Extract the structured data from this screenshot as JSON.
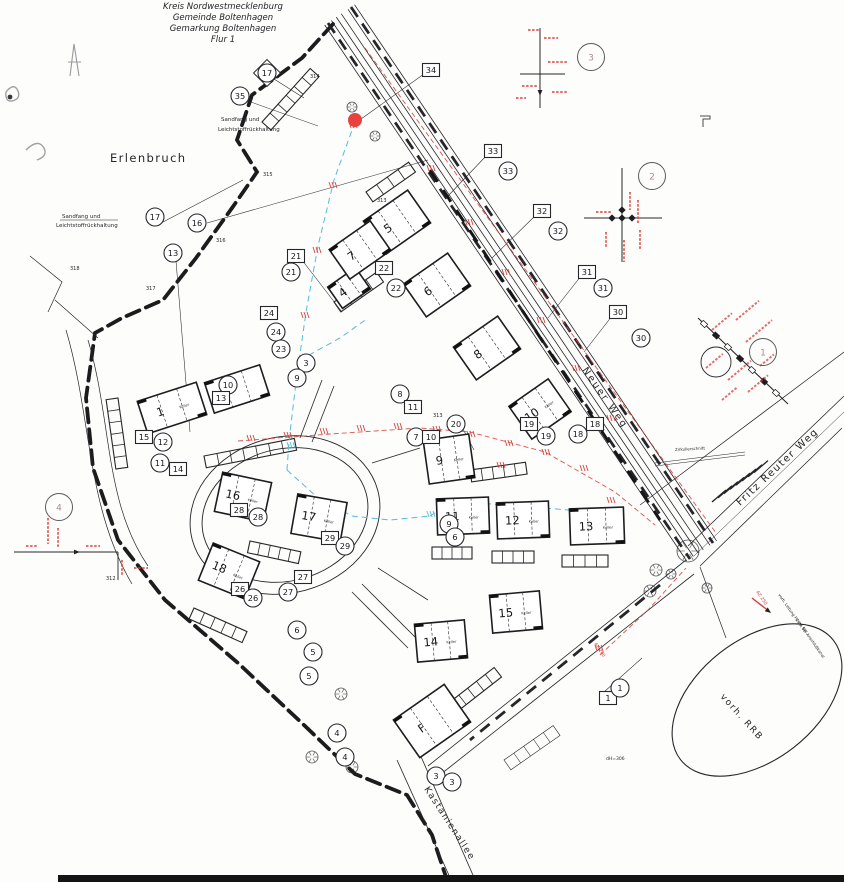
{
  "title": {
    "lines": [
      "Kreis Nordwestmecklenburg",
      "Gemeinde Boltenhagen",
      "Gemarkung Boltenhagen",
      "Flur 1"
    ]
  },
  "colors": {
    "ink": "#26262a",
    "red": "#d9403d",
    "cyan": "#53bcd9",
    "pencil": "#8f8f93",
    "faint": "#5a5a5a"
  },
  "map_texts": [
    {
      "name": "label-erlenbruch",
      "text": "Erlenbruch",
      "x": 110,
      "y": 162,
      "size": 11.5,
      "rot": 0,
      "ls": 1.4,
      "color": "ink"
    },
    {
      "name": "street-neuer-weg",
      "text": "Neuer Weg",
      "x": 582,
      "y": 370,
      "size": 9.5,
      "rot": 55,
      "ls": 2.2,
      "color": "ink"
    },
    {
      "name": "street-fritz-reuter-weg",
      "text": "Fritz Reuter Weg",
      "x": 740,
      "y": 506,
      "size": 10,
      "rot": -43,
      "ls": 1.6,
      "color": "ink"
    },
    {
      "name": "street-kastanienallee",
      "text": "Kastanienallee",
      "x": 424,
      "y": 789,
      "size": 9,
      "rot": 57,
      "ls": 1.4,
      "color": "ink"
    },
    {
      "name": "label-vorh-rrb",
      "text": "vorh. RRB",
      "x": 720,
      "y": 697,
      "size": 9,
      "rot": 48,
      "ls": 1.6,
      "color": "ink"
    },
    {
      "name": "note-sandfang-top-1",
      "text": "Sandfang und",
      "x": 221,
      "y": 121,
      "size": 5.5,
      "rot": 0,
      "ls": 0,
      "color": "ink"
    },
    {
      "name": "note-sandfang-top-2",
      "text": "Leichtstoffrückhaltung",
      "x": 218,
      "y": 131,
      "size": 5.5,
      "rot": 0,
      "ls": 0,
      "color": "ink"
    },
    {
      "name": "note-sandfang-left-1",
      "text": "Sandfang und",
      "x": 62,
      "y": 218,
      "size": 5.5,
      "rot": 0,
      "ls": 0,
      "color": "ink"
    },
    {
      "name": "note-sandfang-left-2",
      "text": "Leichtstoffrückhaltung",
      "x": 56,
      "y": 227,
      "size": 5.5,
      "rot": 0,
      "ls": 0,
      "color": "ink"
    },
    {
      "name": "note-zirkulierschnitt",
      "text": "Zirkulierschnitt",
      "x": 675,
      "y": 451,
      "size": 4,
      "rot": -3,
      "ls": 0,
      "color": "ink"
    },
    {
      "name": "note-dh306",
      "text": "dH=306",
      "x": 606,
      "y": 760,
      "size": 4.5,
      "rot": 0,
      "ls": 0,
      "color": "ink"
    },
    {
      "name": "note-az-250",
      "text": "AZ 250",
      "x": 756,
      "y": 592,
      "size": 4.5,
      "rot": 55,
      "ls": 0,
      "color": "red"
    },
    {
      "name": "note-az-200",
      "text": "AZ 200",
      "x": 594,
      "y": 644,
      "size": 4.5,
      "rot": 55,
      "ls": 0,
      "color": "red"
    },
    {
      "name": "note-leitung-pe",
      "text": "vorh. Leitung PE DA 90",
      "x": 778,
      "y": 595,
      "size": 4,
      "rot": 55,
      "ls": 0,
      "color": "ink"
    },
    {
      "name": "note-sw-anschluss",
      "text": "zum SW-Anschlußkanal",
      "x": 796,
      "y": 620,
      "size": 4,
      "rot": 55,
      "ls": 0,
      "color": "ink"
    },
    {
      "name": "parcel-312",
      "text": "312",
      "x": 106,
      "y": 580,
      "size": 5,
      "rot": 0,
      "ls": 0,
      "color": "ink"
    },
    {
      "name": "parcel-313",
      "text": "313",
      "x": 377,
      "y": 202,
      "size": 5,
      "rot": 0,
      "ls": 0,
      "color": "ink"
    },
    {
      "name": "parcel-313b",
      "text": "313",
      "x": 433,
      "y": 417,
      "size": 5,
      "rot": 0,
      "ls": 0,
      "color": "ink"
    },
    {
      "name": "parcel-314",
      "text": "314",
      "x": 310,
      "y": 78,
      "size": 5,
      "rot": 0,
      "ls": 0,
      "color": "ink"
    },
    {
      "name": "parcel-315",
      "text": "315",
      "x": 263,
      "y": 176,
      "size": 5,
      "rot": 0,
      "ls": 0,
      "color": "ink"
    },
    {
      "name": "parcel-316",
      "text": "316",
      "x": 216,
      "y": 242,
      "size": 5,
      "rot": 0,
      "ls": 0,
      "color": "ink"
    },
    {
      "name": "parcel-317",
      "text": "317",
      "x": 146,
      "y": 290,
      "size": 5,
      "rot": 0,
      "ls": 0,
      "color": "ink"
    },
    {
      "name": "parcel-318",
      "text": "318",
      "x": 70,
      "y": 270,
      "size": 5,
      "rot": 0,
      "ls": 0,
      "color": "ink"
    }
  ],
  "buildings": [
    {
      "n": "1",
      "x": 172,
      "y": 408,
      "w": 62,
      "h": 34,
      "rot": -18,
      "keller": true
    },
    {
      "n": "2",
      "x": 237,
      "y": 389,
      "w": 58,
      "h": 32,
      "rot": -18,
      "keller": false
    },
    {
      "n": "4",
      "x": 349,
      "y": 288,
      "w": 34,
      "h": 26,
      "rot": -35,
      "keller": false
    },
    {
      "n": "5",
      "x": 397,
      "y": 222,
      "w": 54,
      "h": 40,
      "rot": -35,
      "keller": false
    },
    {
      "n": "6",
      "x": 437,
      "y": 285,
      "w": 54,
      "h": 40,
      "rot": -35,
      "keller": false
    },
    {
      "n": "7",
      "x": 360,
      "y": 250,
      "w": 50,
      "h": 36,
      "rot": -35,
      "keller": false
    },
    {
      "n": "8",
      "x": 487,
      "y": 348,
      "w": 54,
      "h": 40,
      "rot": -35,
      "keller": false
    },
    {
      "n": "9",
      "x": 449,
      "y": 459,
      "w": 46,
      "h": 44,
      "rot": -8,
      "keller": true
    },
    {
      "n": "10",
      "x": 540,
      "y": 409,
      "w": 48,
      "h": 40,
      "rot": -35,
      "keller": true
    },
    {
      "n": "11",
      "x": 463,
      "y": 516,
      "w": 52,
      "h": 36,
      "rot": -2,
      "keller": true
    },
    {
      "n": "12",
      "x": 523,
      "y": 520,
      "w": 52,
      "h": 36,
      "rot": -2,
      "keller": true
    },
    {
      "n": "13",
      "x": 597,
      "y": 526,
      "w": 54,
      "h": 36,
      "rot": -2,
      "keller": true
    },
    {
      "n": "14",
      "x": 441,
      "y": 641,
      "w": 50,
      "h": 38,
      "rot": -5,
      "keller": true
    },
    {
      "n": "15",
      "x": 516,
      "y": 612,
      "w": 50,
      "h": 38,
      "rot": -5,
      "keller": true
    },
    {
      "n": "16",
      "x": 243,
      "y": 497,
      "w": 50,
      "h": 40,
      "rot": 12,
      "keller": true
    },
    {
      "n": "17",
      "x": 319,
      "y": 518,
      "w": 50,
      "h": 40,
      "rot": 10,
      "keller": true
    },
    {
      "n": "18",
      "x": 229,
      "y": 571,
      "w": 50,
      "h": 40,
      "rot": 22,
      "keller": true
    },
    {
      "n": "F",
      "x": 432,
      "y": 721,
      "w": 62,
      "h": 46,
      "rot": -35,
      "keller": false
    }
  ],
  "keller_label": "Keller",
  "markers": [
    {
      "n": "17",
      "shape": "diamond",
      "x": 267,
      "y": 73
    },
    {
      "n": "35",
      "shape": "circle",
      "x": 240,
      "y": 96
    },
    {
      "n": "34",
      "shape": "box",
      "x": 431,
      "y": 70
    },
    {
      "n": "3",
      "shape": "detail",
      "x": 591,
      "y": 57
    },
    {
      "n": "33",
      "shape": "box",
      "x": 493,
      "y": 151
    },
    {
      "n": "33",
      "shape": "circle",
      "x": 508,
      "y": 171
    },
    {
      "n": "2",
      "shape": "detail",
      "x": 652,
      "y": 176
    },
    {
      "n": "32",
      "shape": "box",
      "x": 542,
      "y": 211
    },
    {
      "n": "32",
      "shape": "circle",
      "x": 558,
      "y": 231
    },
    {
      "n": "17",
      "shape": "circle",
      "x": 155,
      "y": 217
    },
    {
      "n": "16",
      "shape": "circle",
      "x": 197,
      "y": 223
    },
    {
      "n": "13",
      "shape": "circle",
      "x": 173,
      "y": 253
    },
    {
      "n": "21",
      "shape": "box",
      "x": 296,
      "y": 256
    },
    {
      "n": "21",
      "shape": "circle",
      "x": 291,
      "y": 272
    },
    {
      "n": "22",
      "shape": "box",
      "x": 384,
      "y": 268
    },
    {
      "n": "22",
      "shape": "circle",
      "x": 396,
      "y": 288
    },
    {
      "n": "31",
      "shape": "box",
      "x": 587,
      "y": 272
    },
    {
      "n": "31",
      "shape": "circle",
      "x": 603,
      "y": 288
    },
    {
      "n": "30",
      "shape": "box",
      "x": 618,
      "y": 312
    },
    {
      "n": "30",
      "shape": "circle",
      "x": 641,
      "y": 338
    },
    {
      "n": "24",
      "shape": "box",
      "x": 269,
      "y": 313
    },
    {
      "n": "24",
      "shape": "circle",
      "x": 276,
      "y": 332
    },
    {
      "n": "23",
      "shape": "circle",
      "x": 281,
      "y": 349
    },
    {
      "n": "3",
      "shape": "circle",
      "x": 306,
      "y": 363
    },
    {
      "n": "9",
      "shape": "circle",
      "x": 297,
      "y": 378
    },
    {
      "n": "1",
      "shape": "detail",
      "x": 763,
      "y": 352
    },
    {
      "n": "8",
      "shape": "circle",
      "x": 400,
      "y": 394
    },
    {
      "n": "11",
      "shape": "box",
      "x": 413,
      "y": 407
    },
    {
      "n": "10",
      "shape": "circle",
      "x": 228,
      "y": 385
    },
    {
      "n": "13",
      "shape": "box",
      "x": 221,
      "y": 398
    },
    {
      "n": "15",
      "shape": "box",
      "x": 144,
      "y": 437
    },
    {
      "n": "12",
      "shape": "circle",
      "x": 163,
      "y": 442
    },
    {
      "n": "11",
      "shape": "circle",
      "x": 160,
      "y": 463
    },
    {
      "n": "14",
      "shape": "box",
      "x": 178,
      "y": 469
    },
    {
      "n": "7",
      "shape": "circle",
      "x": 416,
      "y": 437
    },
    {
      "n": "10",
      "shape": "box",
      "x": 431,
      "y": 437
    },
    {
      "n": "20",
      "shape": "circle",
      "x": 456,
      "y": 424
    },
    {
      "n": "19",
      "shape": "box",
      "x": 529,
      "y": 424
    },
    {
      "n": "19",
      "shape": "circle",
      "x": 546,
      "y": 436
    },
    {
      "n": "18",
      "shape": "box",
      "x": 595,
      "y": 424
    },
    {
      "n": "18",
      "shape": "circle",
      "x": 578,
      "y": 434
    },
    {
      "n": "4",
      "shape": "detail",
      "x": 59,
      "y": 507
    },
    {
      "n": "28",
      "shape": "box",
      "x": 239,
      "y": 510
    },
    {
      "n": "28",
      "shape": "circle",
      "x": 258,
      "y": 517
    },
    {
      "n": "9",
      "shape": "circle",
      "x": 449,
      "y": 524
    },
    {
      "n": "6",
      "shape": "circle",
      "x": 455,
      "y": 537
    },
    {
      "n": "29",
      "shape": "box",
      "x": 330,
      "y": 538
    },
    {
      "n": "29",
      "shape": "circle",
      "x": 345,
      "y": 546
    },
    {
      "n": "27",
      "shape": "box",
      "x": 303,
      "y": 577
    },
    {
      "n": "27",
      "shape": "circle",
      "x": 288,
      "y": 592
    },
    {
      "n": "26",
      "shape": "box",
      "x": 240,
      "y": 589
    },
    {
      "n": "26",
      "shape": "circle",
      "x": 253,
      "y": 598
    },
    {
      "n": "6",
      "shape": "circle",
      "x": 297,
      "y": 630
    },
    {
      "n": "5",
      "shape": "circle",
      "x": 313,
      "y": 652
    },
    {
      "n": "5",
      "shape": "circle",
      "x": 309,
      "y": 676
    },
    {
      "n": "4",
      "shape": "circle",
      "x": 337,
      "y": 733
    },
    {
      "n": "4",
      "shape": "circle",
      "x": 345,
      "y": 757
    },
    {
      "n": "3",
      "shape": "circle",
      "x": 436,
      "y": 776
    },
    {
      "n": "3",
      "shape": "circle",
      "x": 452,
      "y": 782
    },
    {
      "n": "1",
      "shape": "box",
      "x": 608,
      "y": 698
    },
    {
      "n": "1",
      "shape": "circle",
      "x": 620,
      "y": 688
    },
    {
      "n": "",
      "shape": "dot",
      "x": 355,
      "y": 120
    }
  ]
}
